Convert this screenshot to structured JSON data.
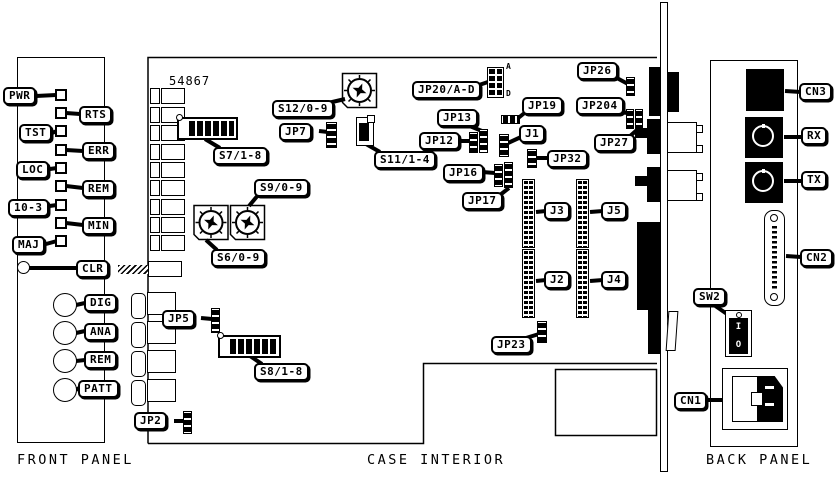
{
  "titles": {
    "front_panel": "FRONT PANEL",
    "case_interior": "CASE INTERIOR",
    "back_panel": "BACK PANEL"
  },
  "board_number": "54867",
  "front_panel": {
    "leds": [
      {
        "label": "PWR"
      },
      {
        "label": "RTS"
      },
      {
        "label": "TST"
      },
      {
        "label": "ERR"
      },
      {
        "label": "LOC"
      },
      {
        "label": "REM"
      },
      {
        "label": "10-3"
      },
      {
        "label": "MIN"
      },
      {
        "label": "MAJ"
      }
    ],
    "buttons": [
      {
        "label": "CLR"
      },
      {
        "label": "DIG"
      },
      {
        "label": "ANA"
      },
      {
        "label": "REM"
      },
      {
        "label": "PATT"
      }
    ]
  },
  "case_interior": {
    "labels": {
      "s12": "S12/0-9",
      "s7": "S7/1-8",
      "jp7": "JP7",
      "s11": "S11/1-4",
      "s9": "S9/0-9",
      "s6": "S6/0-9",
      "jp20": "JP20/A-D",
      "jp19": "JP19",
      "jp13": "JP13",
      "jp12": "JP12",
      "j1": "J1",
      "jp32": "JP32",
      "jp16": "JP16",
      "jp17": "JP17",
      "jp26": "JP26",
      "jp204": "JP204",
      "jp27": "JP27",
      "j3": "J3",
      "j5": "J5",
      "j2": "J2",
      "j4": "J4",
      "jp23": "JP23",
      "jp5": "JP5",
      "s8": "S8/1-8",
      "jp2": "JP2"
    },
    "jp20_pins": {
      "top": "A",
      "bottom": "D"
    }
  },
  "back_panel": {
    "labels": {
      "cn3": "CN3",
      "rx": "RX",
      "tx": "TX",
      "cn2": "CN2",
      "sw2": "SW2",
      "cn1": "CN1"
    },
    "switch_marks": {
      "on": "I",
      "off": "O"
    }
  },
  "colors": {
    "ink": "#000000",
    "paper": "#ffffff"
  }
}
